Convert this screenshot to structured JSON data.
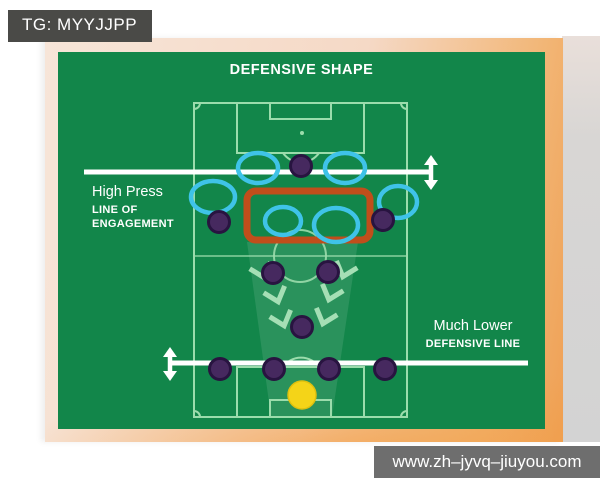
{
  "badge": {
    "text": "TG: MYYJJPP"
  },
  "watermark": {
    "text": "www.zh–jyvq–jiuyou.com"
  },
  "diagram": {
    "title": "DEFENSIVE SHAPE",
    "annotations": {
      "high_press": {
        "title": "High Press",
        "sub1": "LINE OF",
        "sub2": "ENGAGEMENT"
      },
      "defensive_line": {
        "title": "Much Lower",
        "sub1": "DEFENSIVE LINE"
      }
    },
    "colors": {
      "card_green": "#12864a",
      "pitch_line": "#9bdcac",
      "press_line_white": "#ffffff",
      "engagement_box_orange": "#c04e1b",
      "ring_blue": "#3fc3e8",
      "player_purple": "#46295f",
      "goalkeeper_yellow": "#f4d418",
      "chevron_mint": "#a5dfb5",
      "badge_gray": "#4a4a47",
      "watermark_gray": "#6e6e6e",
      "frame_peach": "#f5d9c6",
      "frame_orange": "#efa054"
    },
    "pitch_shapes": [
      {
        "tag": "polygon",
        "name": "press-cone",
        "attrs": {
          "points": "247,242 358,242 332,417 271,417",
          "fill": "#ffffff",
          "fill-opacity": "0.10"
        }
      },
      {
        "tag": "rect",
        "name": "pitch-boundary",
        "attrs": {
          "x": 194,
          "y": 103,
          "width": 213,
          "height": 314,
          "fill": "none",
          "stroke": "#9bdcac",
          "stroke-width": 2
        }
      },
      {
        "tag": "line",
        "name": "halfway-line",
        "attrs": {
          "x1": 194,
          "y1": 256,
          "x2": 407,
          "y2": 256,
          "stroke": "#9bdcac",
          "stroke-width": 2,
          "opacity": "0.65"
        }
      },
      {
        "tag": "circle",
        "name": "center-circle",
        "attrs": {
          "cx": 300,
          "cy": 256,
          "r": 26,
          "fill": "none",
          "stroke": "#9bdcac",
          "stroke-width": 2,
          "opacity": "0.9"
        }
      },
      {
        "tag": "rect",
        "name": "penalty-area-top",
        "attrs": {
          "x": 237,
          "y": 103,
          "width": 127,
          "height": 50,
          "fill": "none",
          "stroke": "#9bdcac",
          "stroke-width": 2
        }
      },
      {
        "tag": "rect",
        "name": "goal-box-top",
        "attrs": {
          "x": 270,
          "y": 103,
          "width": 61,
          "height": 16,
          "fill": "none",
          "stroke": "#9bdcac",
          "stroke-width": 2
        }
      },
      {
        "tag": "path",
        "name": "penalty-arc-top",
        "attrs": {
          "d": "M 283 153 A 22 22 0 0 0 319 153",
          "fill": "none",
          "stroke": "#9bdcac",
          "stroke-width": 2
        }
      },
      {
        "tag": "circle",
        "name": "penalty-spot-top",
        "attrs": {
          "cx": 302,
          "cy": 133,
          "r": 2,
          "fill": "#9bdcac"
        }
      },
      {
        "tag": "rect",
        "name": "penalty-area-bottom",
        "attrs": {
          "x": 237,
          "y": 367,
          "width": 127,
          "height": 50,
          "fill": "none",
          "stroke": "#9bdcac",
          "stroke-width": 2
        }
      },
      {
        "tag": "rect",
        "name": "goal-box-bottom",
        "attrs": {
          "x": 270,
          "y": 400,
          "width": 61,
          "height": 17,
          "fill": "none",
          "stroke": "#9bdcac",
          "stroke-width": 2
        }
      },
      {
        "tag": "path",
        "name": "penalty-arc-bottom",
        "attrs": {
          "d": "M 283 367 A 22 22 0 0 1 319 367",
          "fill": "none",
          "stroke": "#9bdcac",
          "stroke-width": 2
        }
      },
      {
        "tag": "path",
        "name": "corner-arc-top-left",
        "attrs": {
          "d": "M 194 109 A 6 6 0 0 0 200 103",
          "fill": "none",
          "stroke": "#9bdcac",
          "stroke-width": 2
        }
      },
      {
        "tag": "path",
        "name": "corner-arc-top-right",
        "attrs": {
          "d": "M 401 103 A 6 6 0 0 0 407 109",
          "fill": "none",
          "stroke": "#9bdcac",
          "stroke-width": 2
        }
      },
      {
        "tag": "path",
        "name": "corner-arc-bottom-right",
        "attrs": {
          "d": "M 407 411 A 6 6 0 0 0 401 417",
          "fill": "none",
          "stroke": "#9bdcac",
          "stroke-width": 2
        }
      },
      {
        "tag": "path",
        "name": "corner-arc-bottom-left",
        "attrs": {
          "d": "M 200 417 A 6 6 0 0 0 194 411",
          "fill": "none",
          "stroke": "#9bdcac",
          "stroke-width": 2
        }
      },
      {
        "tag": "line",
        "name": "engagement-line",
        "attrs": {
          "x1": 84,
          "y1": 172,
          "x2": 431,
          "y2": 172,
          "stroke": "#ffffff",
          "stroke-width": 5
        }
      },
      {
        "tag": "line",
        "name": "engagement-arrow-stem",
        "attrs": {
          "x1": 431,
          "y1": 163,
          "x2": 431,
          "y2": 182,
          "stroke": "#ffffff",
          "stroke-width": 4.5
        }
      },
      {
        "tag": "polygon",
        "name": "engagement-arrow-up-head",
        "attrs": {
          "points": "431,155 424,165 438,165",
          "fill": "#ffffff"
        }
      },
      {
        "tag": "polygon",
        "name": "engagement-arrow-down-head",
        "attrs": {
          "points": "431,190 424,180 438,180",
          "fill": "#ffffff"
        }
      },
      {
        "tag": "line",
        "name": "defensive-line",
        "attrs": {
          "x1": 170,
          "y1": 363,
          "x2": 528,
          "y2": 363,
          "stroke": "#ffffff",
          "stroke-width": 5
        }
      },
      {
        "tag": "line",
        "name": "defensive-arrow-stem",
        "attrs": {
          "x1": 170,
          "y1": 355,
          "x2": 170,
          "y2": 372,
          "stroke": "#ffffff",
          "stroke-width": 4.5
        }
      },
      {
        "tag": "polygon",
        "name": "defensive-arrow-up-head",
        "attrs": {
          "points": "170,347 163,357 177,357",
          "fill": "#ffffff"
        }
      },
      {
        "tag": "polygon",
        "name": "defensive-arrow-down-head",
        "attrs": {
          "points": "170,381 163,371 177,371",
          "fill": "#ffffff"
        }
      },
      {
        "tag": "rect",
        "name": "engagement-zone-box",
        "attrs": {
          "x": 247,
          "y": 191,
          "width": 123,
          "height": 49,
          "rx": 9,
          "fill": "none",
          "stroke": "#c04e1b",
          "stroke-width": 7
        }
      },
      {
        "tag": "polyline",
        "name": "press-chevron",
        "attrs": {
          "points": "0,0 11,13 22,0",
          "fill": "none",
          "stroke": "#a5dfb5",
          "stroke-width": 5,
          "transform": "translate(251 265) rotate(-18 11 6)"
        }
      },
      {
        "tag": "polyline",
        "name": "press-chevron",
        "attrs": {
          "points": "0,0 11,13 22,0",
          "fill": "none",
          "stroke": "#a5dfb5",
          "stroke-width": 5,
          "transform": "translate(334 264) rotate(18 11 6)"
        }
      },
      {
        "tag": "polyline",
        "name": "press-chevron",
        "attrs": {
          "points": "0,0 11,13 22,0",
          "fill": "none",
          "stroke": "#a5dfb5",
          "stroke-width": 5,
          "transform": "translate(265 289) rotate(-18 11 6)"
        }
      },
      {
        "tag": "polyline",
        "name": "press-chevron",
        "attrs": {
          "points": "0,0 11,13 22,0",
          "fill": "none",
          "stroke": "#a5dfb5",
          "stroke-width": 5,
          "transform": "translate(320 287) rotate(18 11 6)"
        }
      },
      {
        "tag": "polyline",
        "name": "press-chevron",
        "attrs": {
          "points": "0,0 11,13 22,0",
          "fill": "none",
          "stroke": "#a5dfb5",
          "stroke-width": 5,
          "transform": "translate(271 313) rotate(-18 11 6)"
        }
      },
      {
        "tag": "polyline",
        "name": "press-chevron",
        "attrs": {
          "points": "0,0 11,13 22,0",
          "fill": "none",
          "stroke": "#a5dfb5",
          "stroke-width": 5,
          "transform": "translate(314 311) rotate(18 11 6)"
        }
      },
      {
        "tag": "ellipse",
        "name": "press-ring",
        "attrs": {
          "cx": 258,
          "cy": 168,
          "rx": 20,
          "ry": 15,
          "fill": "none",
          "stroke": "#3fc3e8",
          "stroke-width": 4.5
        }
      },
      {
        "tag": "ellipse",
        "name": "press-ring",
        "attrs": {
          "cx": 345,
          "cy": 168,
          "rx": 20,
          "ry": 15,
          "fill": "none",
          "stroke": "#3fc3e8",
          "stroke-width": 4.5
        }
      },
      {
        "tag": "ellipse",
        "name": "press-ring",
        "attrs": {
          "cx": 213,
          "cy": 197,
          "rx": 22,
          "ry": 16,
          "fill": "none",
          "stroke": "#3fc3e8",
          "stroke-width": 4.5
        }
      },
      {
        "tag": "ellipse",
        "name": "press-ring",
        "attrs": {
          "cx": 398,
          "cy": 202,
          "rx": 19,
          "ry": 16,
          "fill": "none",
          "stroke": "#3fc3e8",
          "stroke-width": 4.5
        }
      },
      {
        "tag": "ellipse",
        "name": "press-ring",
        "attrs": {
          "cx": 283,
          "cy": 221,
          "rx": 18,
          "ry": 14,
          "fill": "none",
          "stroke": "#3fc3e8",
          "stroke-width": 4.5
        }
      },
      {
        "tag": "ellipse",
        "name": "press-ring",
        "attrs": {
          "cx": 336,
          "cy": 225,
          "rx": 22,
          "ry": 17,
          "fill": "none",
          "stroke": "#3fc3e8",
          "stroke-width": 4.5
        }
      },
      {
        "tag": "circle",
        "name": "player-striker",
        "attrs": {
          "cx": 301,
          "cy": 166,
          "r": 10.5,
          "fill": "#46295f",
          "stroke": "#281440",
          "stroke-width": 3
        }
      },
      {
        "tag": "circle",
        "name": "player-left-winger",
        "attrs": {
          "cx": 219,
          "cy": 222,
          "r": 10.5,
          "fill": "#46295f",
          "stroke": "#281440",
          "stroke-width": 3
        }
      },
      {
        "tag": "circle",
        "name": "player-right-winger",
        "attrs": {
          "cx": 383,
          "cy": 220,
          "r": 10.5,
          "fill": "#46295f",
          "stroke": "#281440",
          "stroke-width": 3
        }
      },
      {
        "tag": "circle",
        "name": "player-left-cm",
        "attrs": {
          "cx": 273,
          "cy": 273,
          "r": 10.5,
          "fill": "#46295f",
          "stroke": "#281440",
          "stroke-width": 3
        }
      },
      {
        "tag": "circle",
        "name": "player-right-cm",
        "attrs": {
          "cx": 328,
          "cy": 272,
          "r": 10.5,
          "fill": "#46295f",
          "stroke": "#281440",
          "stroke-width": 3
        }
      },
      {
        "tag": "circle",
        "name": "player-pivot",
        "attrs": {
          "cx": 302,
          "cy": 327,
          "r": 10.5,
          "fill": "#46295f",
          "stroke": "#281440",
          "stroke-width": 3
        }
      },
      {
        "tag": "circle",
        "name": "player-left-back",
        "attrs": {
          "cx": 220,
          "cy": 369,
          "r": 10.5,
          "fill": "#46295f",
          "stroke": "#281440",
          "stroke-width": 3
        }
      },
      {
        "tag": "circle",
        "name": "player-left-cb",
        "attrs": {
          "cx": 274,
          "cy": 369,
          "r": 10.5,
          "fill": "#46295f",
          "stroke": "#281440",
          "stroke-width": 3
        }
      },
      {
        "tag": "circle",
        "name": "player-right-cb",
        "attrs": {
          "cx": 329,
          "cy": 369,
          "r": 10.5,
          "fill": "#46295f",
          "stroke": "#281440",
          "stroke-width": 3
        }
      },
      {
        "tag": "circle",
        "name": "player-right-back",
        "attrs": {
          "cx": 385,
          "cy": 369,
          "r": 10.5,
          "fill": "#46295f",
          "stroke": "#281440",
          "stroke-width": 3
        }
      },
      {
        "tag": "circle",
        "name": "goalkeeper",
        "attrs": {
          "cx": 302,
          "cy": 395,
          "r": 14,
          "fill": "#f4d418",
          "stroke": "#dfc00e",
          "stroke-width": 1.5
        }
      }
    ]
  }
}
